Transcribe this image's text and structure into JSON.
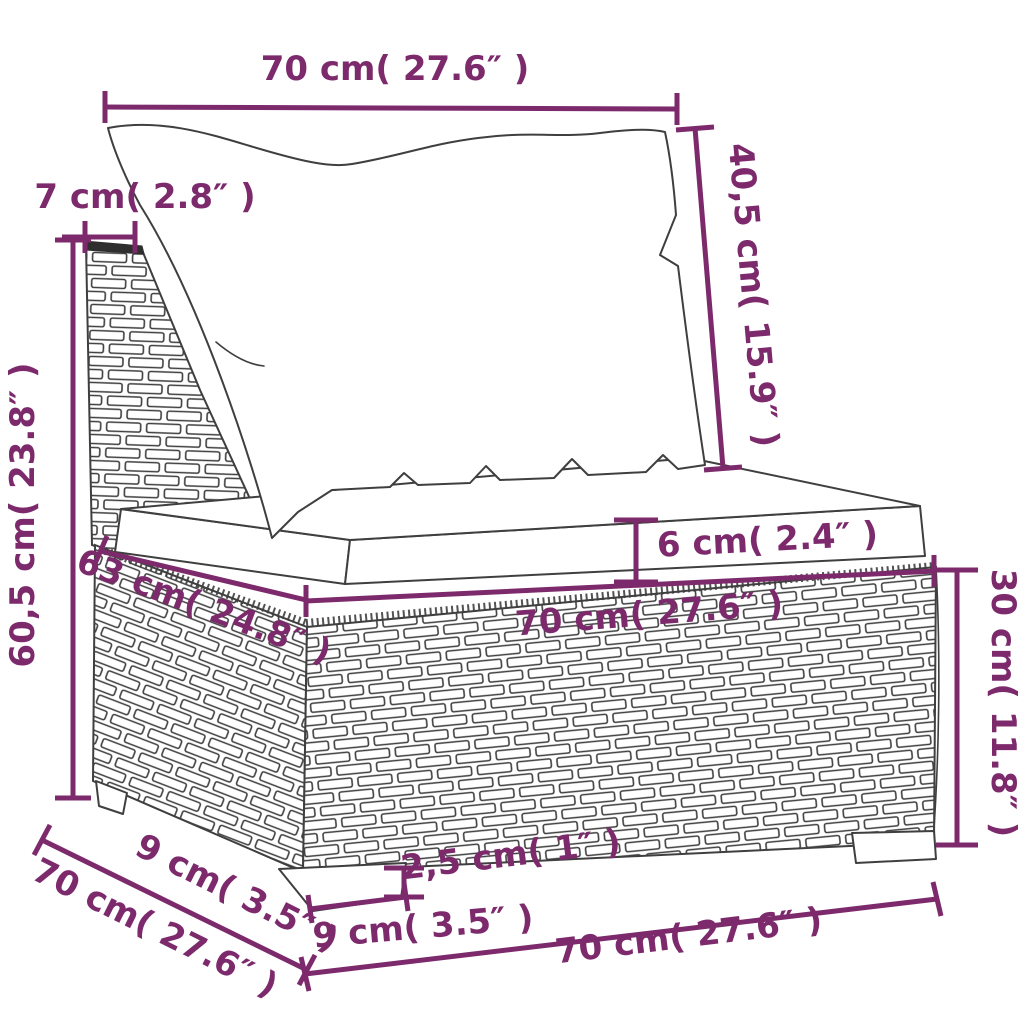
{
  "figure": {
    "kind": "product-dimension-diagram",
    "subject": "poly rattan middle sofa section with back cushion and seat cushion",
    "background": "#ffffff"
  },
  "colors": {
    "annotation": "#7d2a6d",
    "outline": "#3f3f3f",
    "fill": "#ffffff"
  },
  "dims": {
    "top_width": "70 cm( 27.6″ )",
    "post_depth": "7 cm( 2.8″ )",
    "total_height": "60,5 cm( 23.8″ )",
    "back_cushion_height": "40,5 cm( 15.9″ )",
    "seat_cushion_thickness": "6 cm( 2.4″ )",
    "seat_front_width": "70 cm( 27.6″ )",
    "seat_depth": "63 cm( 24.8″ )",
    "base_height": "30 cm( 11.8″ )",
    "foot_depth": "9 cm( 3.5″ )",
    "total_depth": "70 cm( 27.6″ )",
    "plinth_height": "2,5 cm( 1″ )",
    "foot_width": "9 cm( 3.5″ )",
    "bottom_width": "70 cm( 27.6″ )"
  }
}
